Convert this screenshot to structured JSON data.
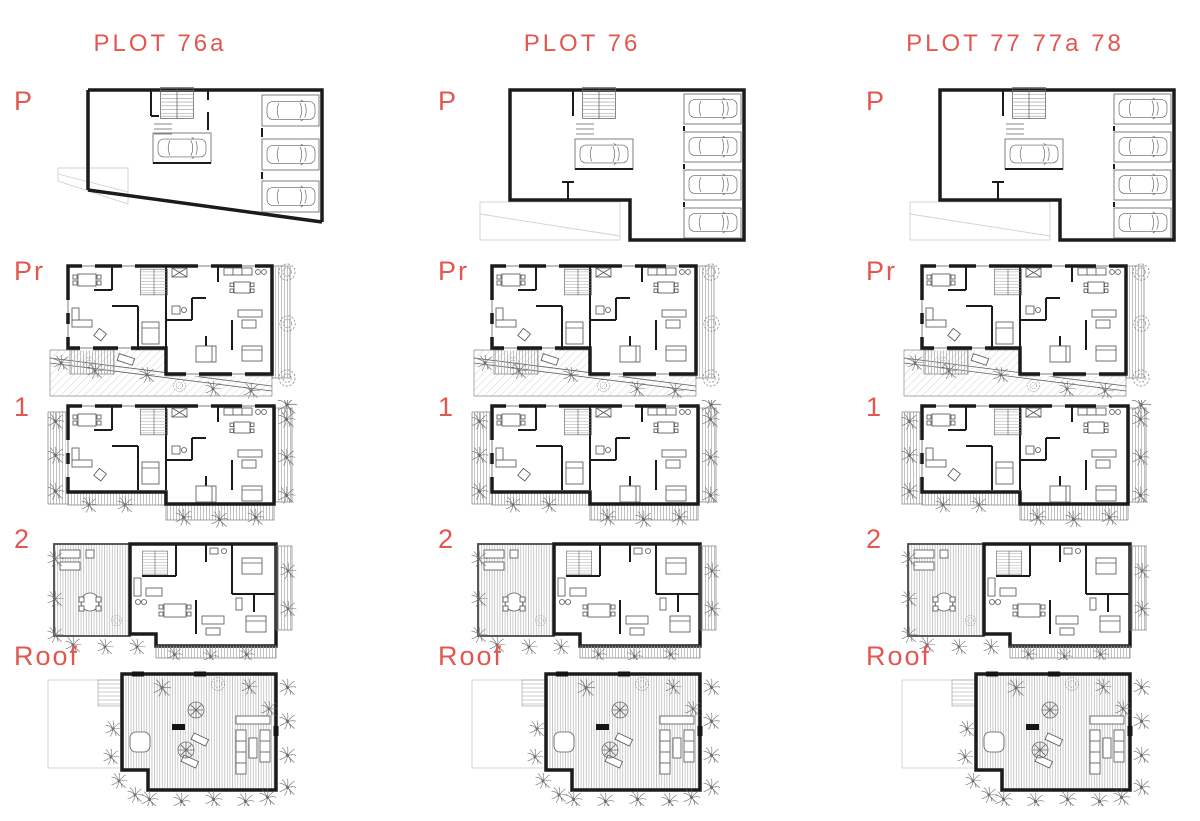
{
  "sheet": {
    "background": "#ffffff"
  },
  "colors": {
    "accent": "#e25750",
    "wall": "#1b1b1b",
    "hatch": "#9a9a9a"
  },
  "columns": [
    {
      "title": "PLOT 76a",
      "floors": [
        "P",
        "Pr",
        "1",
        "2",
        "Roof"
      ]
    },
    {
      "title": "PLOT 76",
      "floors": [
        "P",
        "Pr",
        "1",
        "2",
        "Roof"
      ]
    },
    {
      "title": "PLOT 77 77a 78",
      "floors": [
        "P",
        "Pr",
        "1",
        "2",
        "Roof"
      ]
    }
  ]
}
